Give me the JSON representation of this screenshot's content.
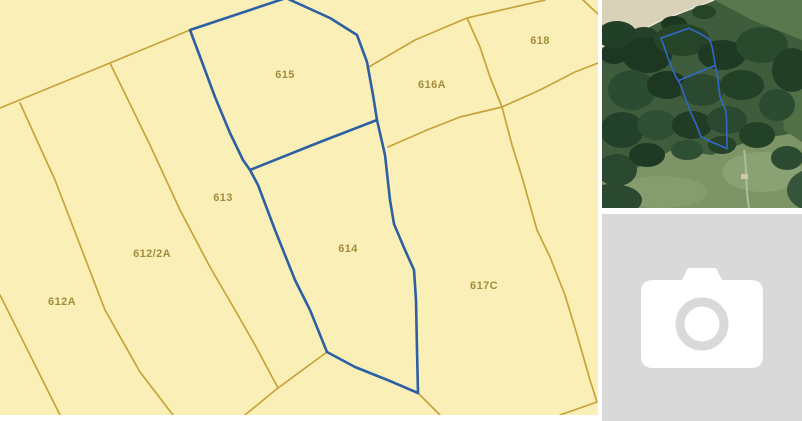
{
  "map_panel": {
    "parcels": [
      {
        "id": "615",
        "label": "615"
      },
      {
        "id": "616A",
        "label": "616A"
      },
      {
        "id": "618",
        "label": "618"
      },
      {
        "id": "613",
        "label": "613"
      },
      {
        "id": "612/2A",
        "label": "612/2A"
      },
      {
        "id": "612A",
        "label": "612A"
      },
      {
        "id": "614",
        "label": "614"
      },
      {
        "id": "617C",
        "label": "617C"
      }
    ],
    "colors": {
      "background": "#fbefb8",
      "boundary_line": "#c7a43b",
      "label_text": "#a38c3d",
      "selection_outline": "#2d5fa3"
    }
  },
  "aerial_panel": {
    "selection_outline_color": "#3069c4"
  },
  "photo_placeholder": {
    "background": "#d9d9d9",
    "icon": "camera-icon",
    "icon_color": "#ffffff"
  }
}
